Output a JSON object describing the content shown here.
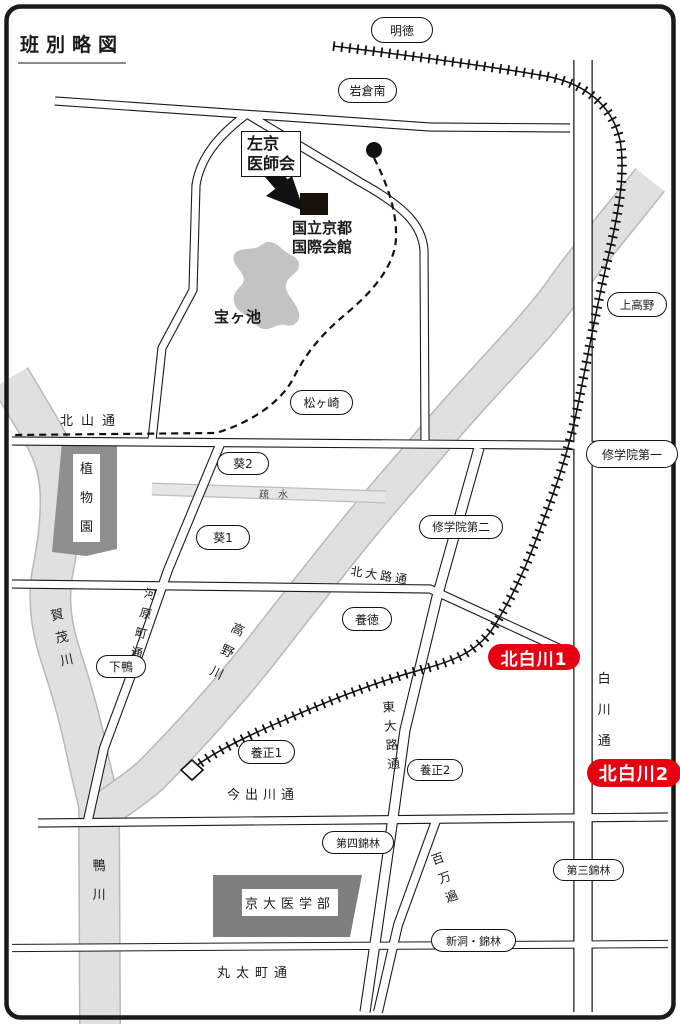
{
  "title": "班別略図",
  "colors": {
    "accent_red": "#e60012",
    "river_gray": "#dedede",
    "park_gray": "#8f8f8f",
    "building_gray": "#7f7f7f",
    "line_black": "#1a1a1a"
  },
  "ovals": {
    "meitoku": "明徳",
    "iwakura_minami": "岩倉南",
    "kami_takano": "上高野",
    "matsugasaki": "松ヶ崎",
    "shugakuin_1": "修学院第一",
    "shugakuin_2": "修学院第二",
    "aoi_2": "葵2",
    "aoi_1": "葵1",
    "yotoku": "養徳",
    "shimogamo": "下鴨",
    "yosei_1": "養正1",
    "yosei_2": "養正2",
    "dai4_kinrin": "第四錦林",
    "dai3_kinrin": "第三錦林",
    "shinto_kinrin": "新洞・錦林"
  },
  "red_labels": {
    "kitashirakawa1": "北白川1",
    "kitashirakawa2": "北白川2"
  },
  "roads": {
    "kitayama": "北山通",
    "kitaoji": "北大路通",
    "kawaramachi": "河原町通",
    "shirakawa": "白川通",
    "higashioji": "東大路通",
    "imadegawa": "今出川通",
    "marutamachi": "丸太町通",
    "hyakumanben": "百万遍"
  },
  "rivers": {
    "kamogawa_upper": "賀茂川",
    "takanogawa": "高野川",
    "kamogawa": "鴨川",
    "sosui": "疏水",
    "takaragaike": "宝ヶ池"
  },
  "landmarks": {
    "sakyo_medical_line1": "左京",
    "sakyo_medical_line2": "医師会",
    "kokusaikaikan_line1": "国立京都",
    "kokusaikaikan_line2": "国際会館",
    "botanical_garden": "植物園",
    "kyodai_med": "京大医学部"
  }
}
